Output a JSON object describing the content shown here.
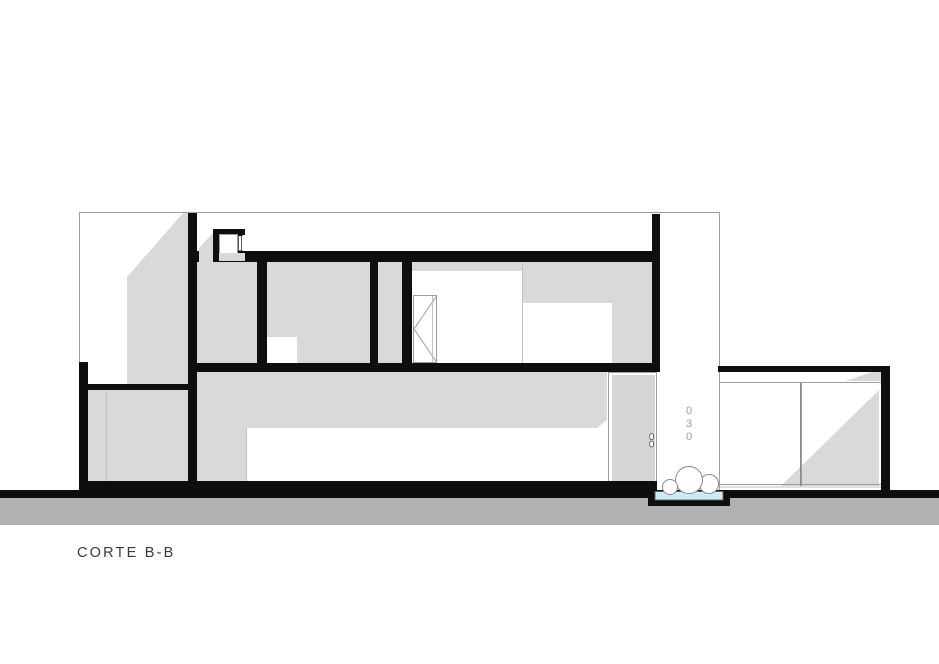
{
  "drawing": {
    "title": "CORTE B-B",
    "house_number": "030",
    "house_number_digits": [
      "0",
      "3",
      "0"
    ],
    "type_label": "architectural-section"
  },
  "palette": {
    "c-ink": "#0e0e0e",
    "c-fill": "#d9d9d9",
    "c-door": "#d6d6d6",
    "c-ground": "#b1b1b1",
    "c-pool": "#cdeaf5",
    "c-line": "#9e9e9e",
    "c-thinline": "#c2c2c2",
    "c-num": "#9b9b9b",
    "c-title": "#3a3a3a"
  }
}
